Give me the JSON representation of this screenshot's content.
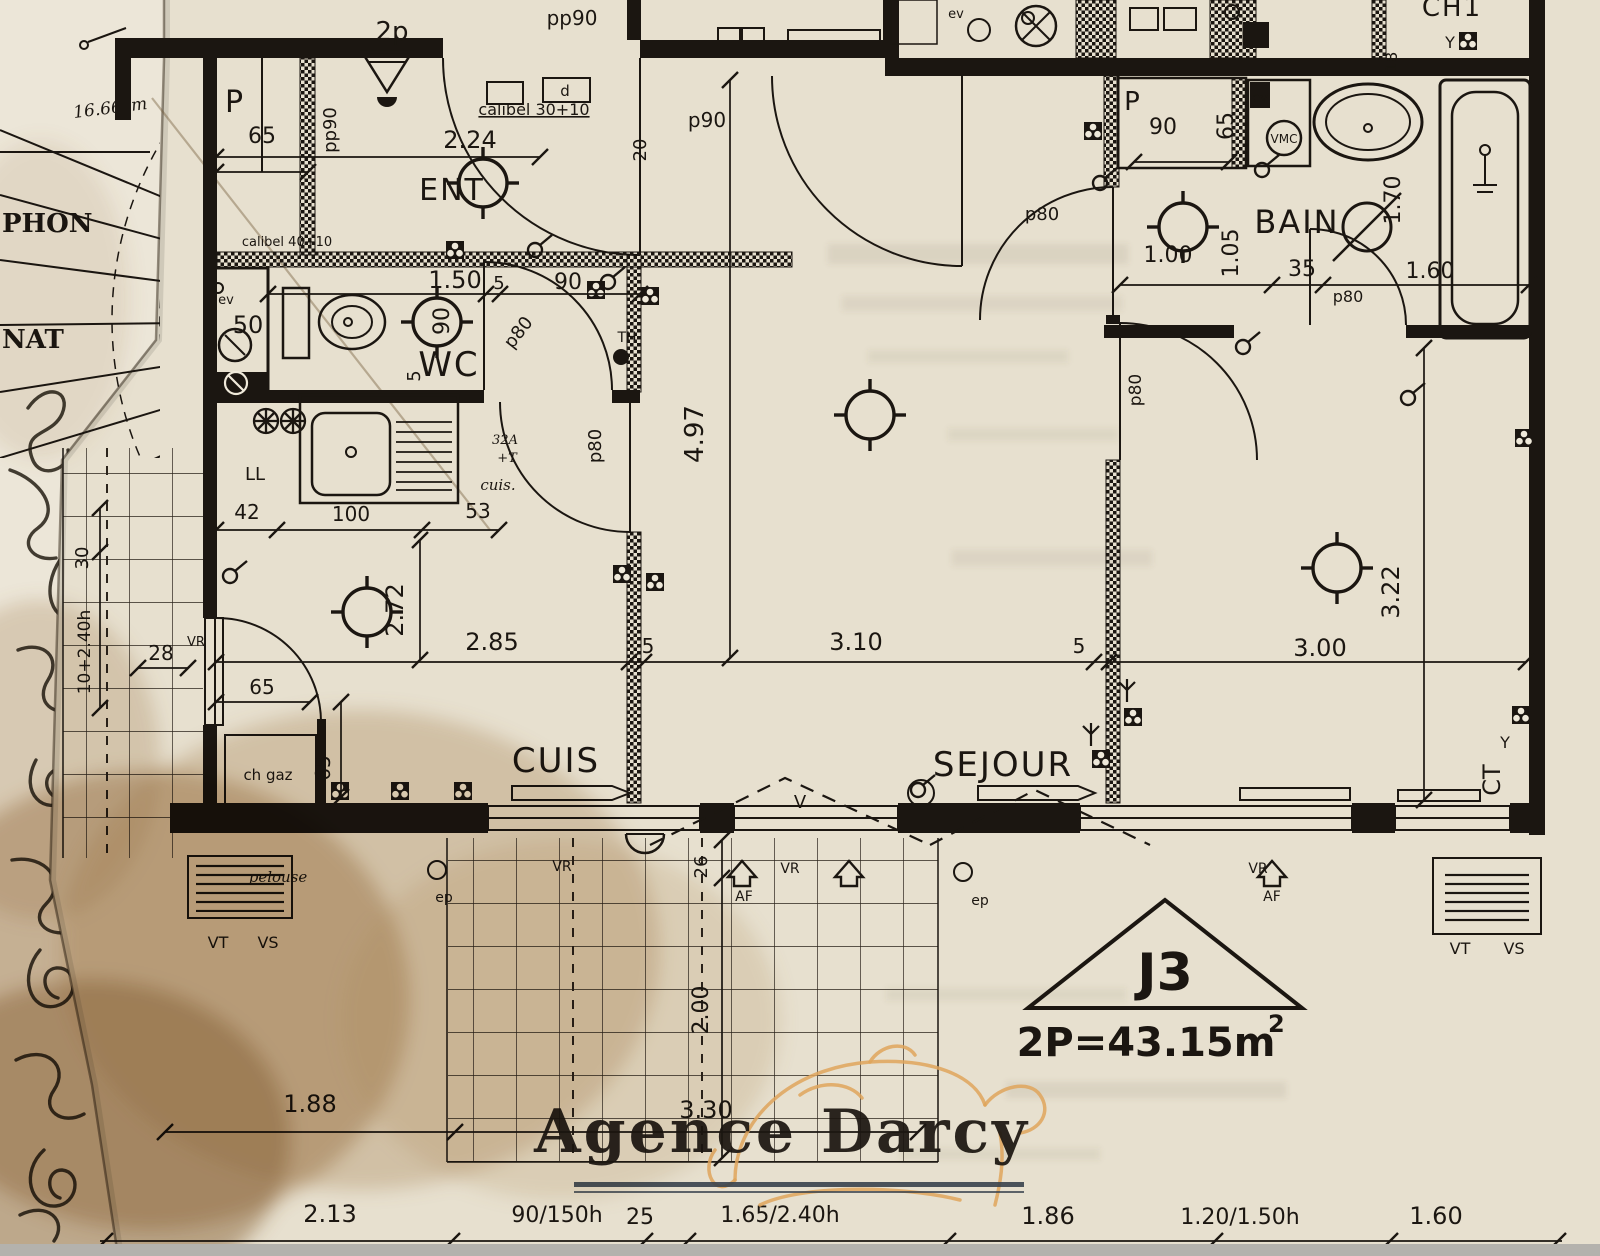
{
  "document_type": "scanned floor plan photo",
  "colors": {
    "paper_main": "#e7e0cf",
    "paper_left_sheet": "#ece6d8",
    "ink": "#1b1611",
    "stain_brown": "#9a6f3f",
    "watermark_text_color": "#39424d",
    "watermark_gold": "#dfa45c",
    "photo_edge_gray": "#b4b2ad"
  },
  "sheet": {
    "phon": "PHON",
    "nat": "NAT",
    "note_1666": "16.66cm"
  },
  "rooms": {
    "ent": "ENT",
    "wc": "WC",
    "cuis": "CUIS",
    "sejour": "SEJOUR",
    "bain": "BAIN",
    "ch1": "CH1",
    "closet_left": "P",
    "closet_bain": "P"
  },
  "unit": {
    "id": "J3",
    "area": "2P=43.15m",
    "area_exp": "2",
    "ct": "CT"
  },
  "watermark": {
    "text": "Agence Darcy"
  },
  "doors": {
    "p90": "p90",
    "pp90_top": "pp90",
    "pp90_side": "pp90",
    "p80_wc": "p80",
    "p80_k": "p80",
    "p80_hall": "p80",
    "p80_bed": "p80",
    "p80_bain": "p80",
    "twop": "2p",
    "calibel30": "calibel 30+10",
    "calibel40": "calibel 40+10",
    "d_label": "d"
  },
  "ann": {
    "th": "TH",
    "ll": "LL",
    "vmc": "VMC",
    "ev_wc": "ev",
    "ev_bain": "ev",
    "ev_kitchen": "ev",
    "chgaz": "ch gaz",
    "a32": "32A",
    "plust": "+T",
    "cuis_hand": "cuis.",
    "pelouse": "pelouse",
    "v": "V",
    "y1": "Y",
    "y2": "Y",
    "af1": "AF",
    "af2": "AF",
    "ep1": "ep",
    "ep2": "ep",
    "vr_balc": "VR",
    "vr_k": "VR",
    "vr_m": "VR",
    "vr_s": "VR",
    "vt_l": "VT",
    "vs_l": "VS",
    "vt_r": "VT",
    "vs_r": "VS"
  },
  "dims": {
    "d224": "2.24",
    "d150": "1.50",
    "n5_wc": "5",
    "n90_wc": "90",
    "n90_wc_v": "90",
    "n5_wc_v": "5",
    "n50": "50",
    "n65_closet": "65",
    "n42": "42",
    "n100": "100",
    "n53": "53",
    "n28": "28",
    "n30": "30",
    "h1040": "10+2.40h",
    "n65_balc": "65",
    "n65_gaz": "65",
    "d272": "2.72",
    "d285": "2.85",
    "n5_a": "5",
    "d310": "3.10",
    "n5_b": "5",
    "d300": "3.00",
    "d497": "4.97",
    "n20": "20",
    "d322": "3.22",
    "n18": "18",
    "n90_p2": "90",
    "n65_p2": "65",
    "d105": "1.05",
    "d100": "1.00",
    "n35": "35",
    "d160_bain": "1.60",
    "d170": "1.70",
    "n26": "26",
    "d200": "2.00",
    "d330": "3.30",
    "d188": "1.88",
    "d213": "2.13",
    "w90150": "90/150h",
    "n25": "25",
    "w165240": "1.65/2.40h",
    "d186": "1.86",
    "w120150": "1.20/1.50h",
    "d160": "1.60"
  }
}
